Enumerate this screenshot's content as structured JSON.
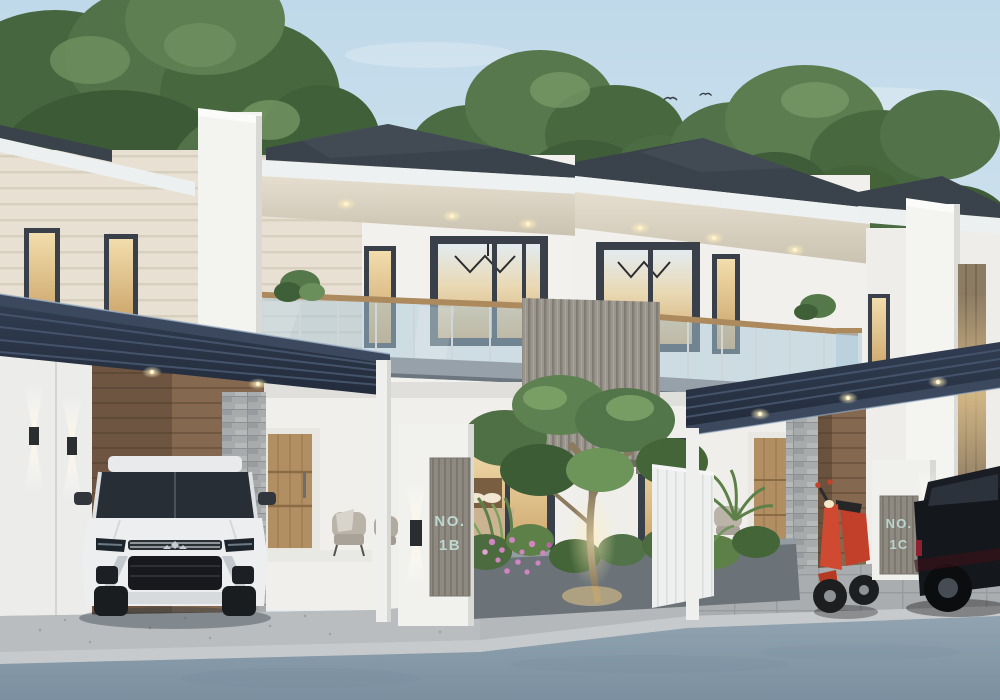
{
  "scene": {
    "type": "3d-architectural-exterior-render",
    "description": "Modern minimalist two-storey twin row houses at dusk with dark hip roofs, glass balconies, carports, front garden, street and parked vehicles",
    "time_of_day": "dusk"
  },
  "signs": {
    "left": {
      "line1": "NO.",
      "line2": "1B"
    },
    "right": {
      "line1": "NO.",
      "line2": "1C"
    }
  },
  "vehicles": [
    "white-suv-front-view",
    "red-scooter",
    "dark-suv-side-view"
  ],
  "counts": {
    "birds": 13,
    "soffit_downlights_left_unit": 3,
    "soffit_downlights_right_unit": 3,
    "carport_downlights_left": 2,
    "carport_downlights_right": 3,
    "wall_sconces_left": 2,
    "sign_lamps": 2
  },
  "palette": {
    "sky_top": "#bfd9ea",
    "sky_bottom": "#e8eef2",
    "roof": "#3a434b",
    "fascia": "#eef1f2",
    "soffit": "#ddd6c7",
    "wall_white": "#f2f1ee",
    "wall_cream": "#e8e1d3",
    "carport_canopy": "#2b3547",
    "window_frame": "#394049",
    "interior_glow": "#edd29e",
    "balcony_glass": "#a9c7da",
    "wood_screen": "#9a968e",
    "wood_door": "#b18f63",
    "stone_pillar": "#a7abac",
    "foliage": "#55754a",
    "flowers": "#cf7fbe",
    "road": "#8496a4",
    "paving": "#b7bbbd",
    "suv_body": "#eceef0",
    "scooter_red": "#c6402a",
    "dark_car": "#14171c",
    "sign_text": "#b9d6cf"
  }
}
